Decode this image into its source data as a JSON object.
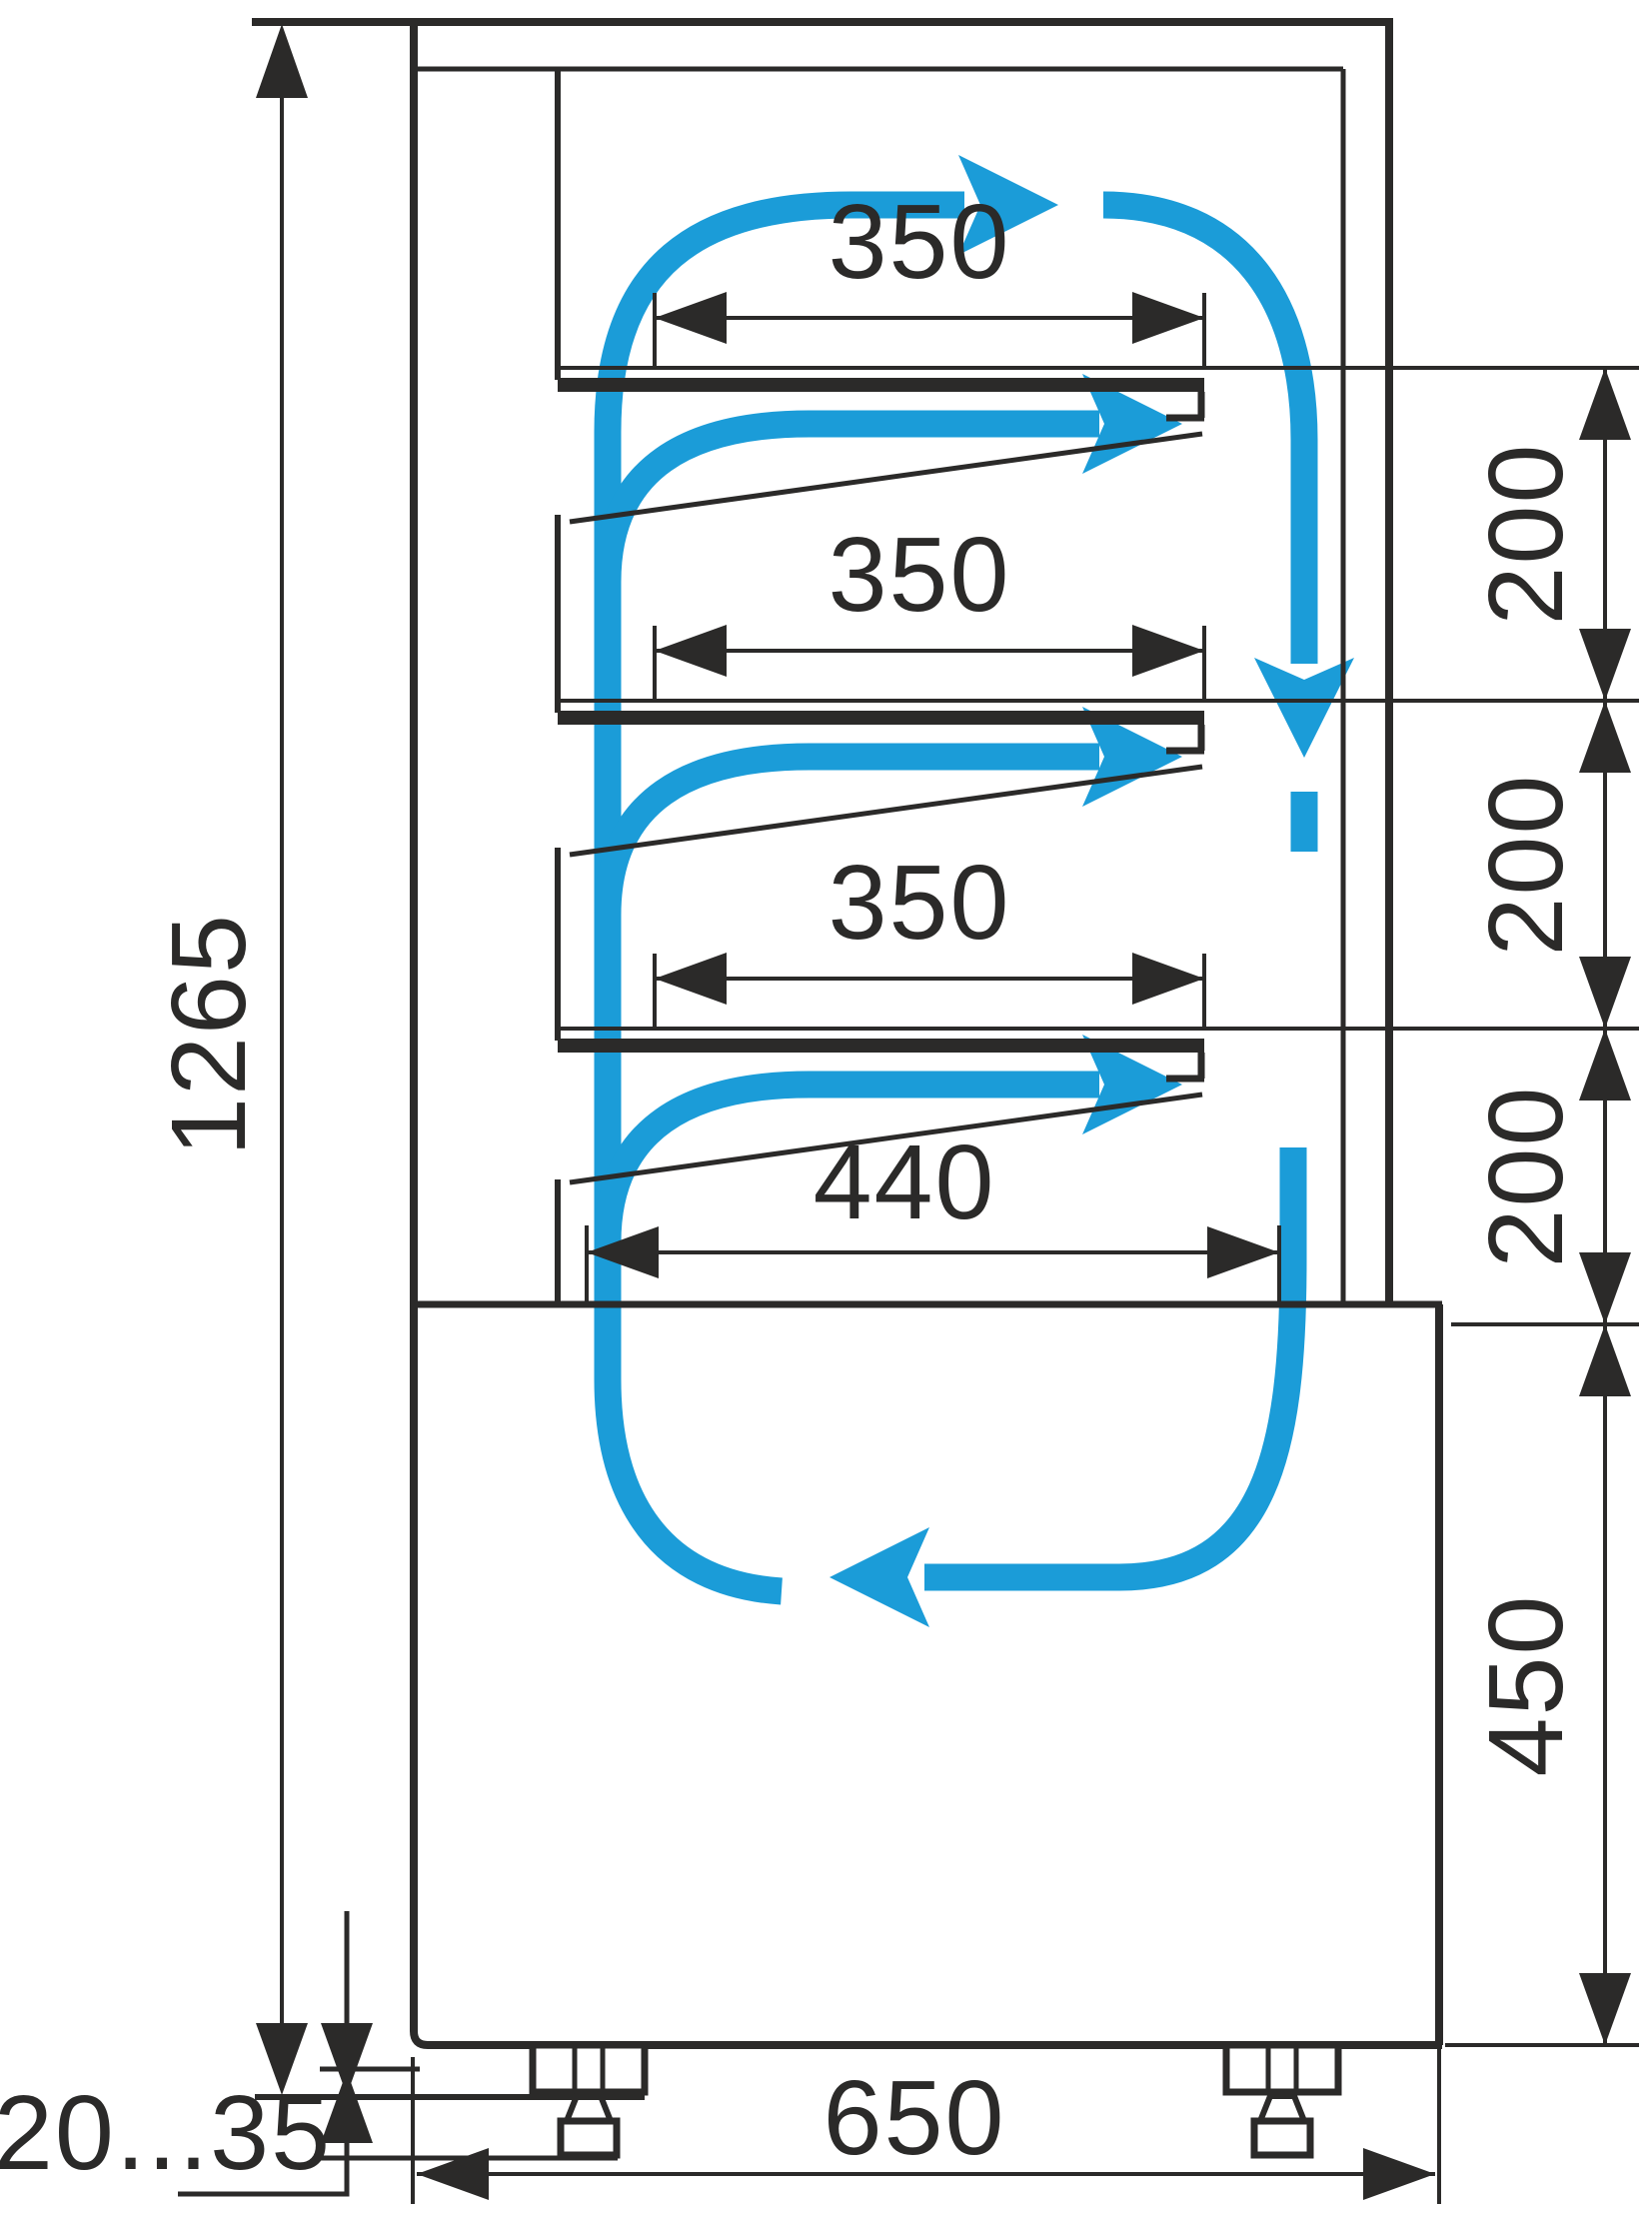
{
  "diagram": {
    "title": "refrigerated-display-case-side-section-with-airflow",
    "background": "#FFFFFF",
    "line_color": "#2B2A29",
    "airflow_color": "#1B9CD8",
    "labels": {
      "shelf1_depth": "350",
      "shelf2_depth": "350",
      "shelf3_depth": "350",
      "deck_depth": "440",
      "gap1": "200",
      "gap2": "200",
      "gap3": "200",
      "base_height": "450",
      "overall_height": "1265",
      "overall_depth": "650",
      "feet_range": "20...35"
    }
  }
}
